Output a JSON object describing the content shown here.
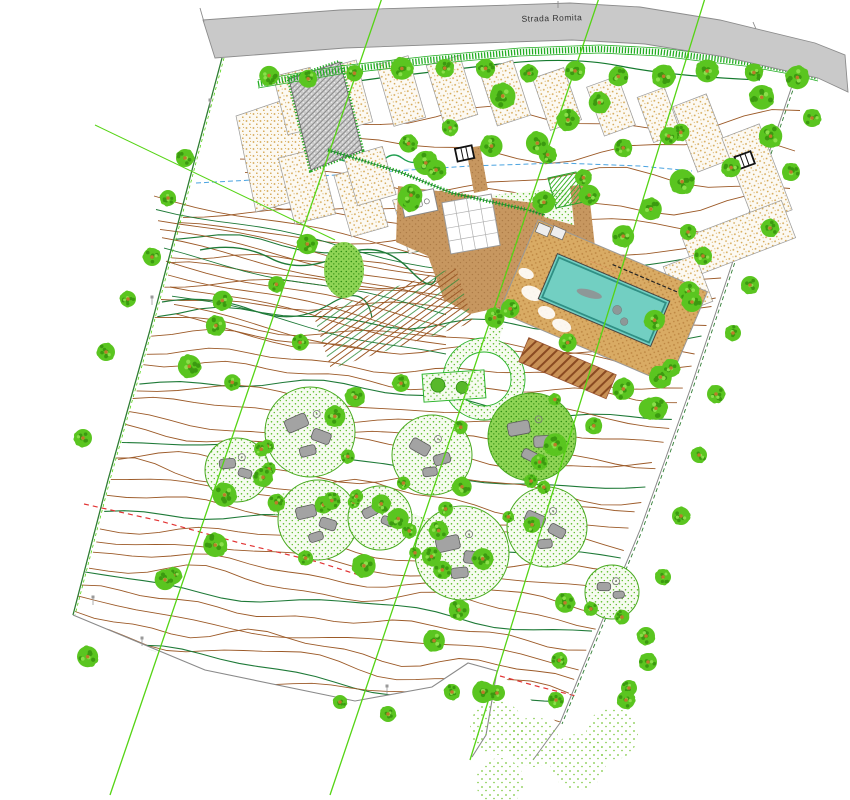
{
  "labels": {
    "road": "Strada Romita",
    "irrigation_note": "∙∙∙∙∙∙∙∙∙∙ ∙∙∙∙∙ ∙∙∙∙",
    "pool_note": "∙∙∙∙∙∙∙∙∙∙∙∙ ∙∙∙∙∙∙∙ ∙∙∙∙∙∙∙∙",
    "boundary_note_left": "∙∙∙∙∙∙∙∙",
    "boundary_note_bottom": "∙∙∙∙∙∙∙∙"
  },
  "colors": {
    "paper": "#ffffff",
    "road_fill": "#c9c9c9",
    "road_edge": "#8c8c8c",
    "road_text": "#333333",
    "hedge_green": "#23ad23",
    "tree_green": "#5ac520",
    "tree_dark": "#3b9a10",
    "tree_light": "#8adf4a",
    "trunk": "#bd7b2b",
    "contour_brown": "#9c5a28",
    "contour_green": "#1f7a38",
    "boundary_green": "#2e7d32",
    "boundary_gray": "#8a8a8a",
    "bright_line": "#55d414",
    "red_dash": "#e23333",
    "blue_dash": "#4aa3e0",
    "sand_dot": "#d3a54e",
    "bed_edge": "#9a9a9a",
    "plaza_brown": "#c79760",
    "plaza_dot": "#ad7c47",
    "deck_sand": "#d9ab64",
    "deck_dot": "#bb8440",
    "pool_teal": "#72cfc2",
    "pool_rim": "#2f8f84",
    "pool_item": "#8d9898",
    "stipple_green": "#5ebe2b",
    "cluster_edge": "#49aa20",
    "boulder_fill": "#a3a3a3",
    "boulder_edge": "#5c5c5c",
    "hatch_gray": "#8a8a8a",
    "wood_brown": "#8a4a22",
    "micro_blue": "#2277cc",
    "micro_red": "#cc2222",
    "micro_green": "#2aa02a"
  }
}
